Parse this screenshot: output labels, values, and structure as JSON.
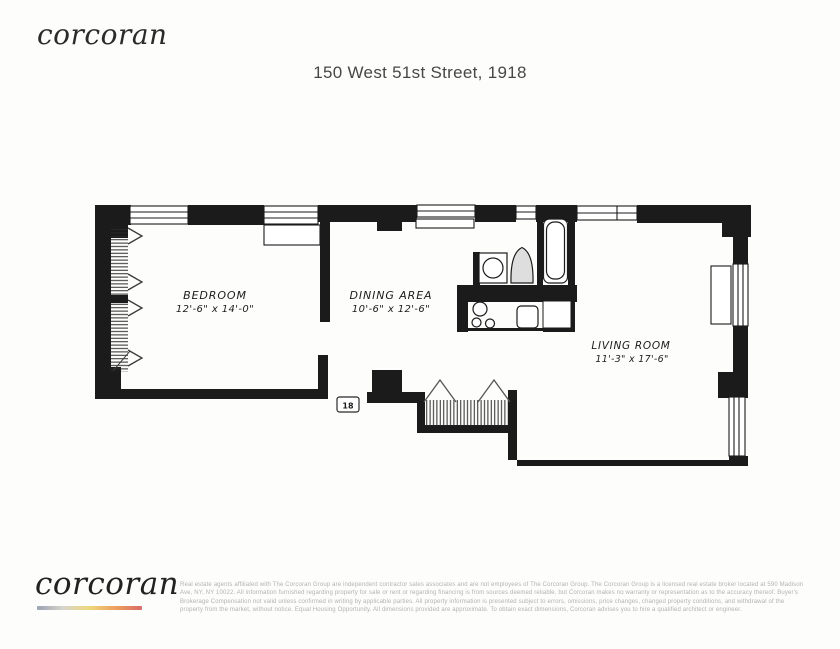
{
  "header": {
    "logo_text": "corcoran",
    "title": "150 West 51st Street, 1918"
  },
  "floor_plan": {
    "rooms": {
      "bedroom": {
        "name": "BEDROOM",
        "dims": "12'-6\" x 14'-0\""
      },
      "dining": {
        "name": "DINING AREA",
        "dims": "10'-6\" x 12'-6\""
      },
      "living": {
        "name": "LIVING ROOM",
        "dims": "11'-3\" x 17'-6\""
      }
    },
    "unit_marker": "18",
    "ink_color": "#1b1b1b",
    "fixture_icons": [
      "window-icon",
      "radiator-icon",
      "closet-hatch-icon",
      "door-swing-icon",
      "bath-sink-icon",
      "toilet-icon",
      "bathtub-icon",
      "stove-burners-icon",
      "kitchen-sink-icon",
      "refrigerator-icon"
    ]
  },
  "footer": {
    "logo_text": "corcoran",
    "gradient_colors": [
      "#9aa3b4",
      "#d8d5cc",
      "#eed77b",
      "#ec9f5d",
      "#d96b68"
    ],
    "disclaimer_lines": [
      "Real estate agents affiliated with The Corcoran Group are independent contractor sales associates and are not employees of The Corcoran Group. The Corcoran Group is a licensed real estate broker located at 590 Madison",
      "Ave, NY, NY 10022. All information furnished regarding property for sale or rent or regarding financing is from sources deemed reliable, but Corcoran makes no warranty or representation as to the accuracy thereof. Buyer's",
      "Brokerage Compensation not valid unless confirmed in writing by applicable parties. All property information is presented subject to errors, omissions, price changes, changed property conditions, and withdrawal of the",
      "property from the market, without notice. Equal Housing Opportunity. All dimensions provided are approximate. To obtain exact dimensions, Corcoran advises you to hire a qualified architect or engineer."
    ]
  }
}
